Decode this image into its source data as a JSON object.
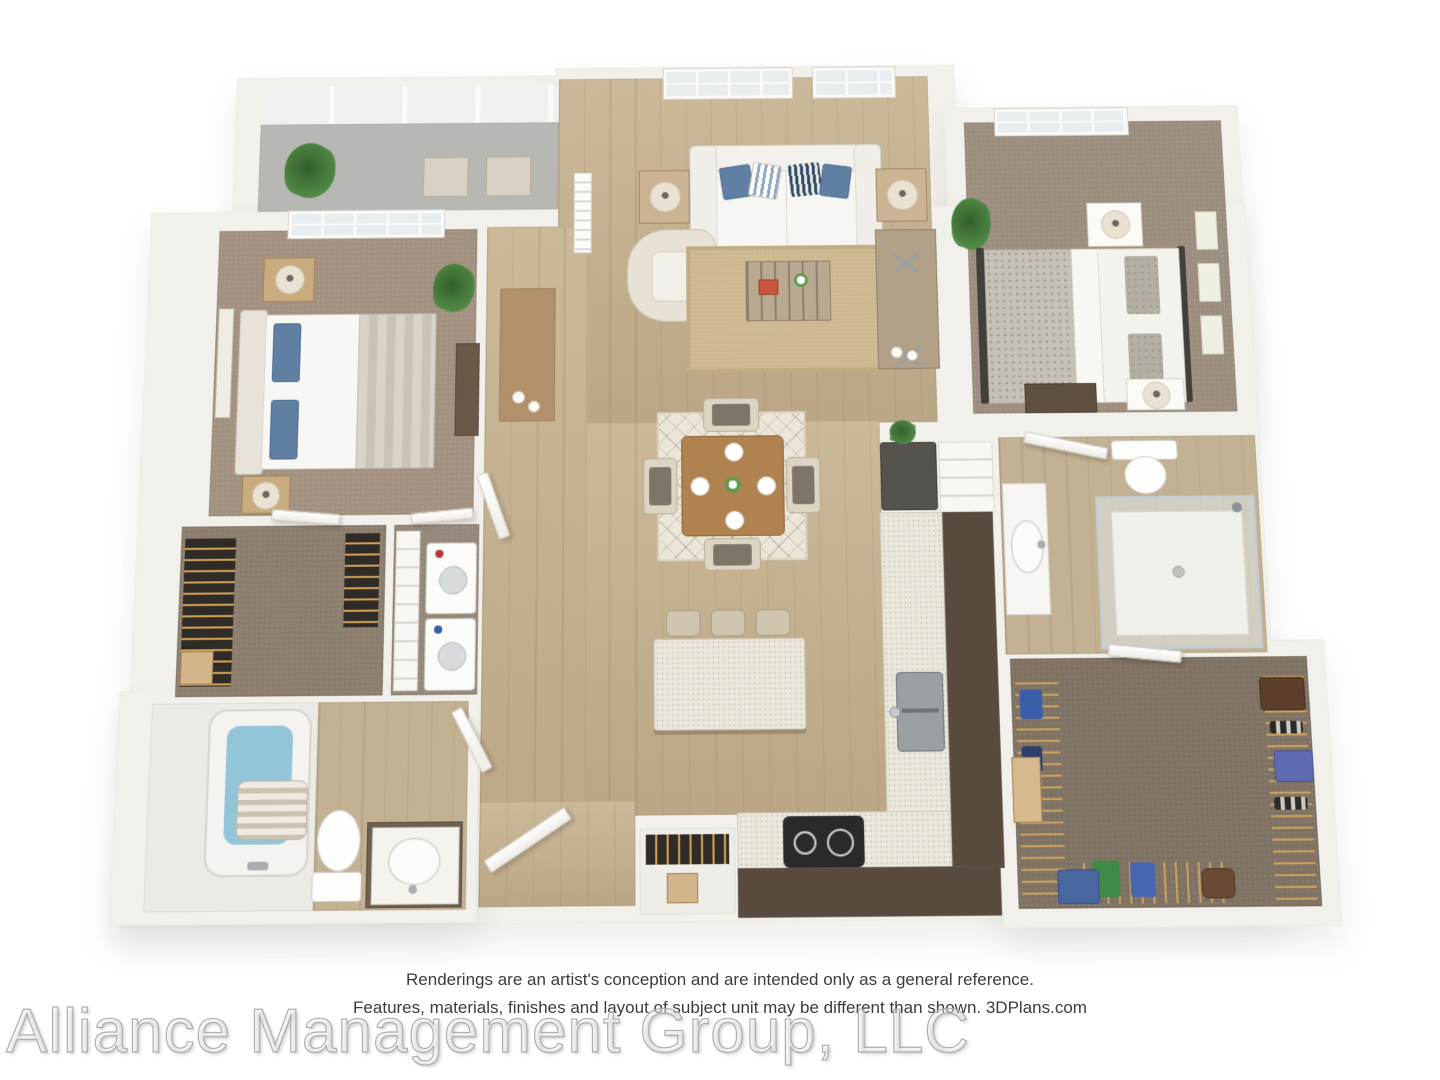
{
  "disclaimer": {
    "line1": "Renderings are an artist's conception and are intended only as a general reference.",
    "line2": "Features, materials, finishes and layout of subject unit may be different than shown. 3DPlans.com"
  },
  "watermark": {
    "text": "Alliance Management Group, LLC"
  },
  "palette": {
    "background": "#ffffff",
    "wall_white": "#f2f0ea",
    "wood_floor": "#c6b18d",
    "bedroom_carpet": "#a29181",
    "closet_carpet": "#8c7e6e",
    "porch_concrete": "#b7b8b4",
    "kitchen_cabinet_dark": "#584a3d",
    "countertop_speckle": "#eae7dc",
    "accent_pillow_blue": "#5f7fa3",
    "tub_water": "#93c5d8",
    "plant_green": "#4a8040",
    "disclaimer_text": "#3c3c3c",
    "watermark_stroke": "#b0aeac"
  }
}
